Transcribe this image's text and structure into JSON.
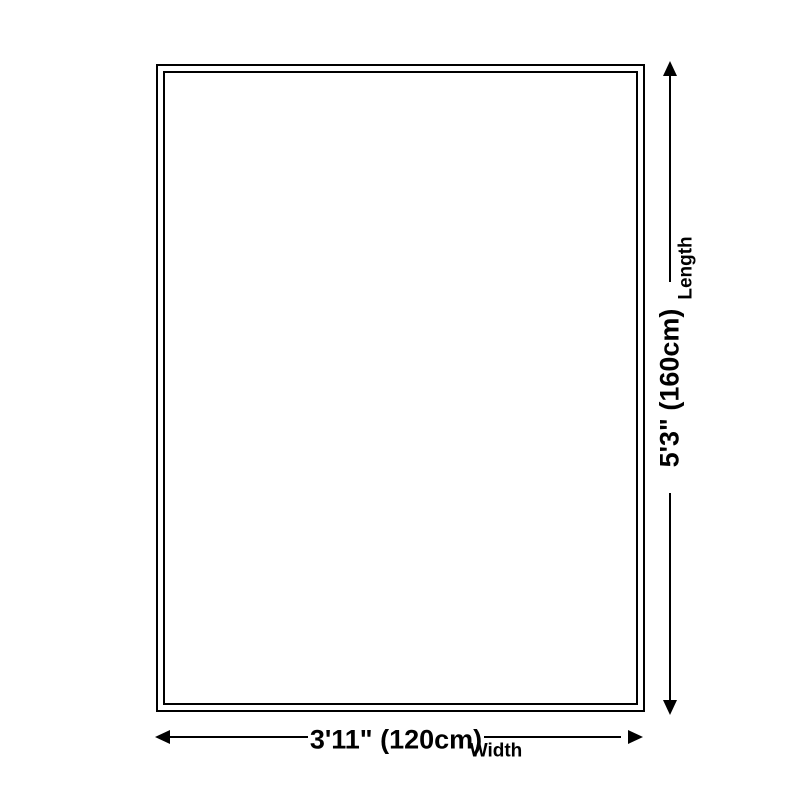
{
  "diagram": {
    "colors": {
      "line": "#000000",
      "background": "#ffffff"
    },
    "length_dimension": {
      "value": "5'3\" (160cm)",
      "axis_label": "Length"
    },
    "width_dimension": {
      "value": "3'11\" (120cm)",
      "axis_label": "Width"
    }
  }
}
